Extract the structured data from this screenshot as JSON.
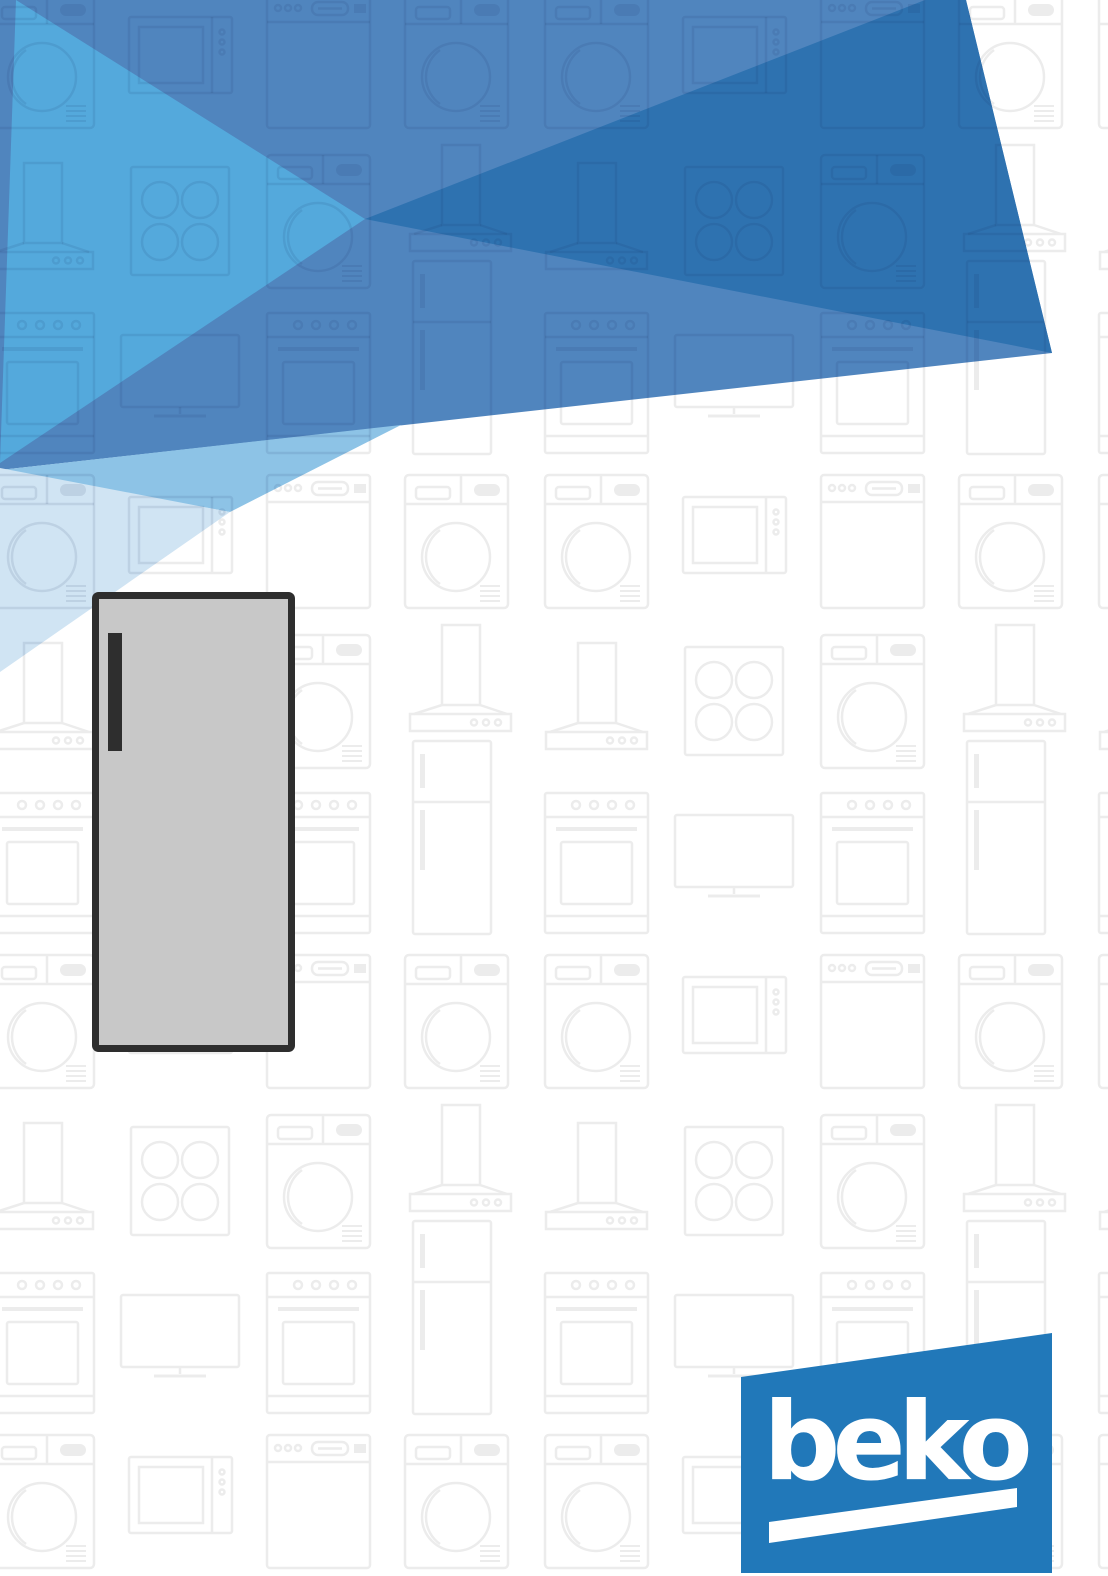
{
  "brand": {
    "logo_text": "beko"
  },
  "palette": {
    "page_background": "#FFFFFF",
    "band_blue": "#5085BE",
    "dark_blue": "#2E72B0",
    "bright_blue": "#54A9DC",
    "light_blue": "#8DC3E6",
    "pale_blue": "#D0E4F3",
    "beko_blue": "#2178B9",
    "logo_text_white": "#FFFFFF",
    "freezer_body_gray": "#C8C8C8",
    "freezer_frame_dark": "#2E2E2E",
    "pattern_stroke": "#ECECEC",
    "pattern_overlay": "rgba(15,40,85,0.10)"
  },
  "hero_illustration": {
    "name": "single-door-freezer"
  },
  "background_pattern": {
    "style": "outlined-appliance-icons",
    "icons": [
      "washing-machine-icon",
      "dishwasher-icon",
      "cooker-hood-icon",
      "cooktop-icon",
      "oven-range-icon",
      "tv-icon",
      "microwave-icon",
      "refrigerator-icon"
    ]
  }
}
